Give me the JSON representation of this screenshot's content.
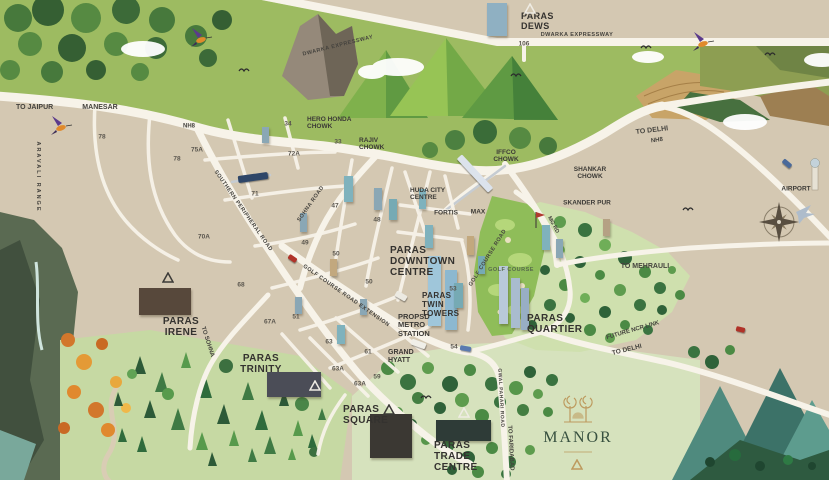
{
  "colors": {
    "map_base": "#d4c8b2",
    "road": "#f7f3e9",
    "label_dark": "#3b3a36",
    "golf_green": "#8fbd59",
    "meadow_green": "#cfe0ae",
    "forest_dark": "#2f6239",
    "manor_green": "#37503f",
    "manor_gold": "#bd9a5e",
    "mountain_teal": "#4f8a7e",
    "water": "#a8cfc4",
    "accent_red": "#b03228"
  },
  "map": {
    "labels": [
      {
        "id": "paras-dews-label",
        "t": "PARAS\nDEWS",
        "x": 521,
        "y": 11,
        "s": 9,
        "a": "tl",
        "c": "p",
        "i": true
      },
      {
        "id": "paras-downtown-centre-label",
        "t": "PARAS\nDOWNTOWN\nCENTRE",
        "x": 390,
        "y": 245,
        "s": 10,
        "a": "tl",
        "c": "p",
        "i": true
      },
      {
        "id": "paras-twin-towers-label",
        "t": "PARAS\nTWIN\nTOWERS",
        "x": 422,
        "y": 292,
        "s": 8,
        "a": "tl",
        "c": "p",
        "i": true
      },
      {
        "id": "paras-quartier-label",
        "t": "PARAS\nQUARTIER",
        "x": 527,
        "y": 313,
        "s": 10,
        "a": "tl",
        "c": "p",
        "i": true
      },
      {
        "id": "paras-irene-label",
        "t": "PARAS\nIRENE",
        "x": 181,
        "y": 316,
        "s": 10,
        "a": "tc",
        "c": "p",
        "i": true
      },
      {
        "id": "paras-trinity-label",
        "t": "PARAS\nTRINITY",
        "x": 261,
        "y": 353,
        "s": 10,
        "a": "tc",
        "c": "p",
        "i": true
      },
      {
        "id": "paras-square-label",
        "t": "PARAS\nSQUARE",
        "x": 343,
        "y": 404,
        "s": 10,
        "a": "tl",
        "c": "p",
        "i": true
      },
      {
        "id": "paras-trade-centre-label",
        "t": "PARAS\nTRADE\nCENTRE",
        "x": 434,
        "y": 440,
        "s": 10,
        "a": "tl",
        "c": "p",
        "i": true
      },
      {
        "id": "manor-label",
        "t": "MANOR",
        "x": 578,
        "y": 438,
        "s": 16,
        "c": "b",
        "i": true,
        "ls": 2
      },
      {
        "id": "hero-honda-chowk-label",
        "t": "HERO HONDA\nCHOWK",
        "x": 307,
        "y": 116,
        "s": 6.5,
        "a": "tl",
        "c": "l"
      },
      {
        "id": "rajiv-chowk-label",
        "t": "RAJIV\nCHOWK",
        "x": 359,
        "y": 137,
        "s": 6.5,
        "a": "tl",
        "c": "l"
      },
      {
        "id": "iffco-chowk-label",
        "t": "IFFCO\nCHOWK",
        "x": 506,
        "y": 149,
        "s": 6.5,
        "a": "tc",
        "c": "l"
      },
      {
        "id": "shankar-chowk-label",
        "t": "SHANKAR\nCHOWK",
        "x": 590,
        "y": 166,
        "s": 6.5,
        "a": "tc",
        "c": "l"
      },
      {
        "id": "skander-pur-label",
        "t": "SKANDER PUR",
        "x": 587,
        "y": 203,
        "s": 6.5,
        "c": "l"
      },
      {
        "id": "huda-city-centre-label",
        "t": "HUDA CITY\nCENTRE",
        "x": 410,
        "y": 187,
        "s": 6.5,
        "a": "tl",
        "c": "l"
      },
      {
        "id": "fortis-label",
        "t": "FORTIS",
        "x": 446,
        "y": 213,
        "s": 6.5,
        "c": "l"
      },
      {
        "id": "max-label",
        "t": "MAX",
        "x": 478,
        "y": 212,
        "s": 6.5,
        "c": "l"
      },
      {
        "id": "grand-hyatt-label",
        "t": "GRAND\nHYATT",
        "x": 388,
        "y": 349,
        "s": 7,
        "a": "tl",
        "c": "l"
      },
      {
        "id": "propsd-metro-station-label",
        "t": "PROPSD\nMETRO\nSTATION",
        "x": 398,
        "y": 313,
        "s": 7.5,
        "a": "tl",
        "c": "l"
      },
      {
        "id": "golf-course-label",
        "t": "GOLF COURSE",
        "x": 511,
        "y": 270,
        "s": 5.5,
        "c": "g"
      },
      {
        "id": "airport-label",
        "t": "AIRPORT",
        "x": 796,
        "y": 189,
        "s": 6.5,
        "c": "l"
      },
      {
        "id": "to-jaipur-label",
        "t": "TO JAIPUR",
        "x": 16,
        "y": 104,
        "s": 7,
        "a": "tl",
        "c": "r"
      },
      {
        "id": "manesar-label",
        "t": "MANESAR",
        "x": 100,
        "y": 108,
        "s": 7,
        "c": "r"
      },
      {
        "id": "dwarka-expressway-west-label",
        "t": "DWARKA EXPRESSWAY",
        "x": 338,
        "y": 46,
        "s": 5.5,
        "r": -14,
        "c": "r",
        "ls": 0.5
      },
      {
        "id": "dwarka-expressway-east-label",
        "t": "DWARKA EXPRESSWAY",
        "x": 577,
        "y": 35,
        "s": 5.5,
        "c": "r",
        "ls": 0.5
      },
      {
        "id": "nh8-west-label",
        "t": "NH8",
        "x": 189,
        "y": 127,
        "s": 6,
        "c": "r"
      },
      {
        "id": "to-delhi-north-label",
        "t": "TO DELHI",
        "x": 652,
        "y": 131,
        "s": 7,
        "r": -7,
        "c": "r"
      },
      {
        "id": "nh8-east-label",
        "t": "NH8",
        "x": 657,
        "y": 141,
        "s": 6,
        "r": -7,
        "c": "r"
      },
      {
        "id": "southern-peripheral-road-label",
        "t": "SOUTHERN PERIPHERAL ROAD",
        "x": 243,
        "y": 211,
        "s": 5.5,
        "r": 55,
        "c": "r",
        "ls": 0.5
      },
      {
        "id": "sohna-road-label",
        "t": "SOHNA ROAD",
        "x": 311,
        "y": 204,
        "s": 5.5,
        "r": -55,
        "c": "r",
        "ls": 0.5
      },
      {
        "id": "golf-course-road-extension-label",
        "t": "GOLF COURSE ROAD EXTENSION",
        "x": 346,
        "y": 296,
        "s": 5.5,
        "r": 35,
        "c": "r",
        "ls": 0.5
      },
      {
        "id": "golf-course-road-label",
        "t": "GOLF COURSE ROAD",
        "x": 488,
        "y": 258,
        "s": 5.5,
        "r": -58,
        "c": "r",
        "ls": 0.5
      },
      {
        "id": "mg-rd-label",
        "t": "MG RD",
        "x": 553,
        "y": 225,
        "s": 5.5,
        "r": 62,
        "c": "r"
      },
      {
        "id": "to-sohna-label",
        "t": "TO SOHNA",
        "x": 207,
        "y": 342,
        "s": 6,
        "r": 72,
        "c": "r"
      },
      {
        "id": "gwal-pahari-road-label",
        "t": "GWAL PAHARI ROAD",
        "x": 500,
        "y": 398,
        "s": 5,
        "r": 87,
        "c": "r",
        "ls": 0.5
      },
      {
        "id": "to-faridabad-label",
        "t": "TO FARIDABAD",
        "x": 510,
        "y": 448,
        "s": 6,
        "r": 87,
        "c": "r"
      },
      {
        "id": "to-mehrauli-label",
        "t": "TO MEHRAULI",
        "x": 645,
        "y": 267,
        "s": 7,
        "c": "r"
      },
      {
        "id": "future-ncr-link-label",
        "t": "FUTURE NCR LINK",
        "x": 633,
        "y": 331,
        "s": 6,
        "r": -16,
        "c": "r"
      },
      {
        "id": "to-delhi-south-label",
        "t": "TO DELHI",
        "x": 627,
        "y": 350,
        "s": 6.5,
        "r": -14,
        "c": "r"
      },
      {
        "id": "aravali-range-label",
        "t": "ARAVALI RANGE",
        "x": 38,
        "y": 177,
        "s": 5.5,
        "r": 90,
        "c": "r",
        "ls": 2
      },
      {
        "id": "sector-106-label",
        "t": "106",
        "x": 524,
        "y": 44,
        "s": 6.5,
        "c": "s"
      },
      {
        "id": "sector-78-label",
        "t": "78",
        "x": 102,
        "y": 137,
        "s": 6.5,
        "c": "s"
      },
      {
        "id": "sector-75a-label",
        "t": "75A",
        "x": 197,
        "y": 150,
        "s": 6.5,
        "c": "s"
      },
      {
        "id": "sector-78-south-label",
        "t": "78",
        "x": 177,
        "y": 159,
        "s": 6.5,
        "c": "s"
      },
      {
        "id": "sector-34-label",
        "t": "34",
        "x": 288,
        "y": 124,
        "s": 6.5,
        "c": "s"
      },
      {
        "id": "sector-33-label",
        "t": "33",
        "x": 338,
        "y": 142,
        "s": 6.5,
        "c": "s"
      },
      {
        "id": "sector-72a-label",
        "t": "72A",
        "x": 294,
        "y": 154,
        "s": 6.5,
        "c": "s"
      },
      {
        "id": "sector-71-label",
        "t": "71",
        "x": 255,
        "y": 194,
        "s": 6.5,
        "c": "s"
      },
      {
        "id": "sector-70a-label",
        "t": "70A",
        "x": 204,
        "y": 237,
        "s": 6.5,
        "c": "s"
      },
      {
        "id": "sector-47-label",
        "t": "47",
        "x": 335,
        "y": 206,
        "s": 6.5,
        "c": "s"
      },
      {
        "id": "sector-48-label",
        "t": "48",
        "x": 377,
        "y": 220,
        "s": 6.5,
        "c": "s"
      },
      {
        "id": "sector-49-label",
        "t": "49",
        "x": 305,
        "y": 243,
        "s": 6.5,
        "c": "s"
      },
      {
        "id": "sector-50-label",
        "t": "50",
        "x": 336,
        "y": 254,
        "s": 6.5,
        "c": "s"
      },
      {
        "id": "sector-50-south-label",
        "t": "50",
        "x": 369,
        "y": 282,
        "s": 6.5,
        "c": "s"
      },
      {
        "id": "sector-51-label",
        "t": "51",
        "x": 296,
        "y": 317,
        "s": 6.5,
        "c": "s"
      },
      {
        "id": "sector-53-label",
        "t": "53",
        "x": 453,
        "y": 289,
        "s": 6.5,
        "c": "s"
      },
      {
        "id": "sector-54-label",
        "t": "54",
        "x": 454,
        "y": 347,
        "s": 6.5,
        "c": "s"
      },
      {
        "id": "sector-68-label",
        "t": "68",
        "x": 241,
        "y": 285,
        "s": 6.5,
        "c": "s"
      },
      {
        "id": "sector-67a-label",
        "t": "67A",
        "x": 270,
        "y": 322,
        "s": 6.5,
        "c": "s"
      },
      {
        "id": "sector-63-label",
        "t": "63",
        "x": 329,
        "y": 342,
        "s": 6.5,
        "c": "s"
      },
      {
        "id": "sector-61-label",
        "t": "61",
        "x": 368,
        "y": 352,
        "s": 6.5,
        "c": "s"
      },
      {
        "id": "sector-63a-label",
        "t": "63A",
        "x": 338,
        "y": 369,
        "s": 6.5,
        "c": "s"
      },
      {
        "id": "sector-59-label",
        "t": "59",
        "x": 377,
        "y": 377,
        "s": 6.5,
        "c": "s"
      },
      {
        "id": "sector-63a-south-label",
        "t": "63A",
        "x": 360,
        "y": 384,
        "s": 6.5,
        "c": "s"
      }
    ],
    "markers": [
      {
        "id": "paras-dews-marker",
        "x": 530,
        "y": 6,
        "col": "#efece4"
      },
      {
        "id": "paras-irene-marker",
        "x": 168,
        "y": 275,
        "col": "#3b3a37"
      },
      {
        "id": "paras-trinity-marker",
        "x": 315,
        "y": 383,
        "col": "#efece4"
      },
      {
        "id": "paras-square-marker",
        "x": 389,
        "y": 407,
        "col": "#3b3a37"
      },
      {
        "id": "paras-trade-centre-marker",
        "x": 464,
        "y": 410,
        "col": "#efece4"
      },
      {
        "id": "manor-marker",
        "x": 577,
        "y": 462,
        "col": "#bd9a5e"
      }
    ],
    "buildings": [
      {
        "id": "paras-dews-building",
        "x": 487,
        "y": 3,
        "w": 20,
        "h": 33,
        "bg": "#8fb0c2",
        "p": "v"
      },
      {
        "id": "paras-irene-building",
        "x": 139,
        "y": 288,
        "w": 52,
        "h": 27,
        "bg": "#57483b",
        "p": "h"
      },
      {
        "id": "paras-trinity-building",
        "x": 267,
        "y": 372,
        "w": 54,
        "h": 25,
        "bg": "#4b4d57",
        "p": "h"
      },
      {
        "id": "paras-square-building",
        "x": 370,
        "y": 414,
        "w": 42,
        "h": 44,
        "bg": "#3b3833",
        "p": "gold"
      },
      {
        "id": "paras-trade-centre-building",
        "x": 436,
        "y": 420,
        "w": 55,
        "h": 21,
        "bg": "#2e3b37",
        "p": "h"
      },
      {
        "id": "twin-tower-a",
        "x": 428,
        "y": 256,
        "w": 13,
        "h": 70,
        "bg": "#9fc6da",
        "p": "w"
      },
      {
        "id": "twin-tower-b",
        "x": 445,
        "y": 270,
        "w": 12,
        "h": 60,
        "bg": "#8cb8d0",
        "p": "w"
      },
      {
        "id": "quartier-tower-a",
        "x": 499,
        "y": 266,
        "w": 9,
        "h": 58,
        "bg": "#b9c9d9",
        "p": "w"
      },
      {
        "id": "quartier-tower-b",
        "x": 511,
        "y": 278,
        "w": 9,
        "h": 50,
        "bg": "#a9bccf",
        "p": "w"
      },
      {
        "id": "quartier-tower-c",
        "x": 521,
        "y": 288,
        "w": 8,
        "h": 42,
        "bg": "#98aec4",
        "p": "w"
      },
      {
        "id": "tower",
        "x": 344,
        "y": 176,
        "w": 9,
        "h": 26,
        "bg": "#7fb2bd",
        "p": "w"
      },
      {
        "id": "tower",
        "x": 374,
        "y": 188,
        "w": 8,
        "h": 22,
        "bg": "#8aa7b5",
        "p": "w"
      },
      {
        "id": "tower",
        "x": 389,
        "y": 199,
        "w": 8,
        "h": 21,
        "bg": "#76aab4",
        "p": "w"
      },
      {
        "id": "tower",
        "x": 300,
        "y": 213,
        "w": 7,
        "h": 19,
        "bg": "#8aa7b5",
        "p": "w"
      },
      {
        "id": "tower",
        "x": 425,
        "y": 225,
        "w": 8,
        "h": 23,
        "bg": "#7fb2bd",
        "p": "w"
      },
      {
        "id": "tower",
        "x": 467,
        "y": 236,
        "w": 7,
        "h": 19,
        "bg": "#c2a87e",
        "p": "w"
      },
      {
        "id": "tower",
        "x": 330,
        "y": 259,
        "w": 7,
        "h": 17,
        "bg": "#c2a87e",
        "p": "w"
      },
      {
        "id": "tower",
        "x": 295,
        "y": 297,
        "w": 7,
        "h": 17,
        "bg": "#8aa7b5",
        "p": "w"
      },
      {
        "id": "tower",
        "x": 337,
        "y": 325,
        "w": 8,
        "h": 19,
        "bg": "#7fb2bd",
        "p": "w"
      },
      {
        "id": "tower",
        "x": 454,
        "y": 283,
        "w": 9,
        "h": 25,
        "bg": "#76aab4",
        "p": "w"
      },
      {
        "id": "tower",
        "x": 542,
        "y": 225,
        "w": 8,
        "h": 25,
        "bg": "#7fb2bd",
        "p": "w"
      },
      {
        "id": "tower",
        "x": 556,
        "y": 239,
        "w": 7,
        "h": 19,
        "bg": "#8aa7b5",
        "p": "w"
      },
      {
        "id": "tower",
        "x": 603,
        "y": 219,
        "w": 7,
        "h": 17,
        "bg": "#b5a184",
        "p": "w"
      },
      {
        "id": "tower",
        "x": 419,
        "y": 189,
        "w": 7,
        "h": 20,
        "bg": "#7fb2bd",
        "p": "w"
      },
      {
        "id": "tower",
        "x": 360,
        "y": 299,
        "w": 7,
        "h": 16,
        "bg": "#8aa7b5",
        "p": "w"
      },
      {
        "id": "tower",
        "x": 478,
        "y": 256,
        "w": 7,
        "h": 18,
        "bg": "#76aab4",
        "p": "w"
      },
      {
        "id": "tower",
        "x": 262,
        "y": 127,
        "w": 7,
        "h": 16,
        "bg": "#8aa7b5",
        "p": "w"
      }
    ],
    "vehicles": [
      {
        "id": "metro-train-spr",
        "x": 238,
        "y": 174,
        "w": 30,
        "h": 7,
        "bg": "#2e4668",
        "r": -8
      },
      {
        "id": "metro-train-mg",
        "x": 452,
        "y": 170,
        "w": 46,
        "h": 7,
        "bg": "#dce3ec",
        "r": 47
      },
      {
        "id": "red-car",
        "x": 288,
        "y": 256,
        "w": 9,
        "h": 5,
        "bg": "#b03228",
        "r": 35
      },
      {
        "id": "white-truck",
        "x": 395,
        "y": 293,
        "w": 12,
        "h": 6,
        "bg": "#eceae2",
        "r": 30
      },
      {
        "id": "white-bus",
        "x": 411,
        "y": 341,
        "w": 15,
        "h": 6,
        "bg": "#f0efe8",
        "r": 20
      },
      {
        "id": "blue-truck",
        "x": 460,
        "y": 346,
        "w": 11,
        "h": 5,
        "bg": "#5a7ab0",
        "r": 10
      },
      {
        "id": "blue-car",
        "x": 782,
        "y": 161,
        "w": 10,
        "h": 5,
        "bg": "#4a6a9a",
        "r": 40
      },
      {
        "id": "red-car-east",
        "x": 736,
        "y": 327,
        "w": 9,
        "h": 5,
        "bg": "#b03228",
        "r": 14
      }
    ],
    "birds": [
      {
        "type": "hummingbird",
        "x": 198,
        "y": 38
      },
      {
        "type": "hummingbird",
        "x": 58,
        "y": 126
      },
      {
        "type": "hummingbird",
        "x": 700,
        "y": 42
      },
      {
        "type": "gull",
        "x": 646,
        "y": 48
      },
      {
        "type": "gull",
        "x": 770,
        "y": 55
      },
      {
        "type": "gull",
        "x": 688,
        "y": 210
      },
      {
        "type": "gull",
        "x": 426,
        "y": 398
      },
      {
        "type": "gull",
        "x": 244,
        "y": 71
      },
      {
        "type": "gull",
        "x": 516,
        "y": 76
      }
    ],
    "icons": [
      {
        "name": "compass-rose-icon",
        "x": 779,
        "y": 222
      },
      {
        "name": "airport-tower-icon",
        "x": 814,
        "y": 170
      },
      {
        "name": "airplane-icon",
        "x": 799,
        "y": 207
      },
      {
        "name": "golf-flag-icon",
        "x": 536,
        "y": 212
      },
      {
        "name": "manor-emblem-icon",
        "x": 578,
        "y": 410
      }
    ]
  }
}
